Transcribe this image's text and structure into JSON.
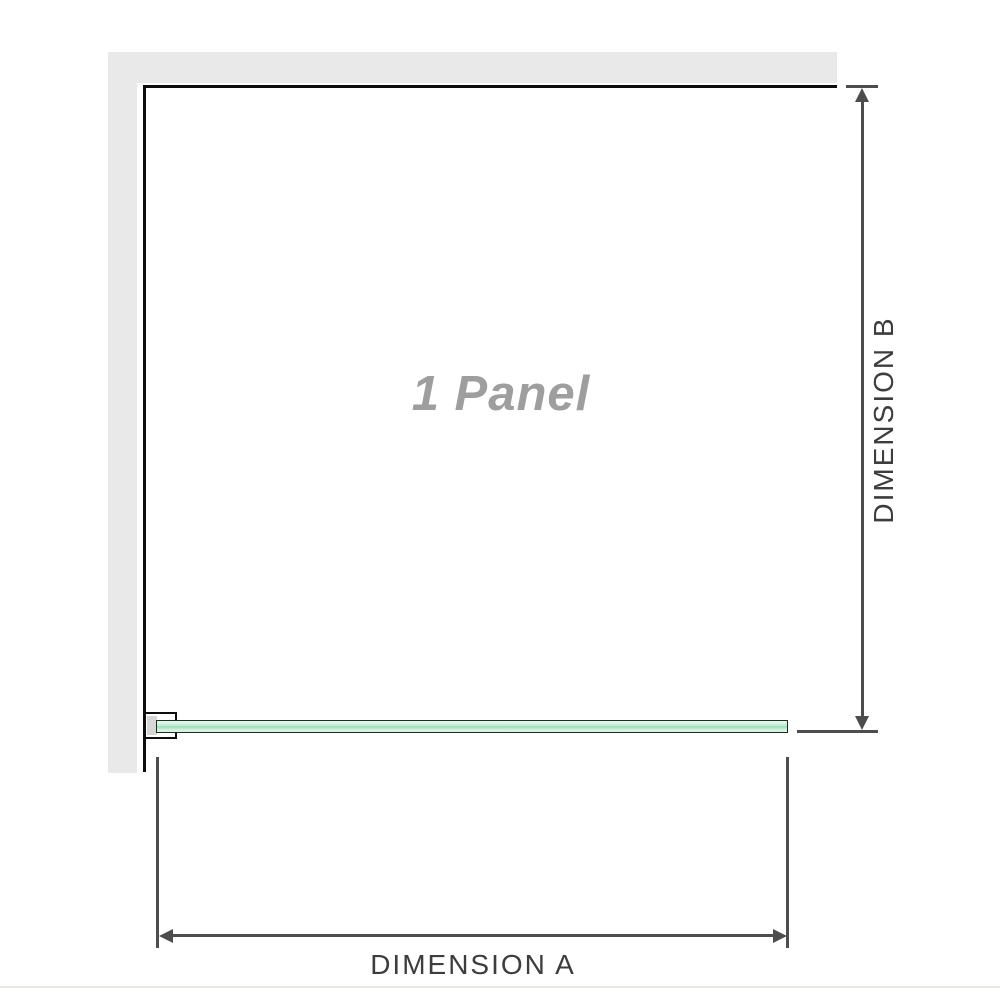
{
  "diagram": {
    "panel_watermark": "1 Panel",
    "dimension_a": {
      "label": "DIMENSION A",
      "orientation": "horizontal"
    },
    "dimension_b": {
      "label": "DIMENSION B",
      "orientation": "vertical"
    }
  },
  "colors": {
    "wall_gray": "#e9e9e9",
    "panel_outline": "#0d0d0d",
    "dimension_gray": "#4d4d4d",
    "label_text": "#3d3d3d",
    "watermark_gray": "#9e9e9e",
    "glass_green": "#9edcba",
    "glass_green_light": "#d2efe0",
    "glass_border": "#16311f",
    "bracket_pad_gray": "#d6d6d6"
  },
  "icons": {
    "arrow_up": "triangle-up",
    "arrow_down": "triangle-down",
    "arrow_left": "triangle-left",
    "arrow_right": "triangle-right"
  }
}
